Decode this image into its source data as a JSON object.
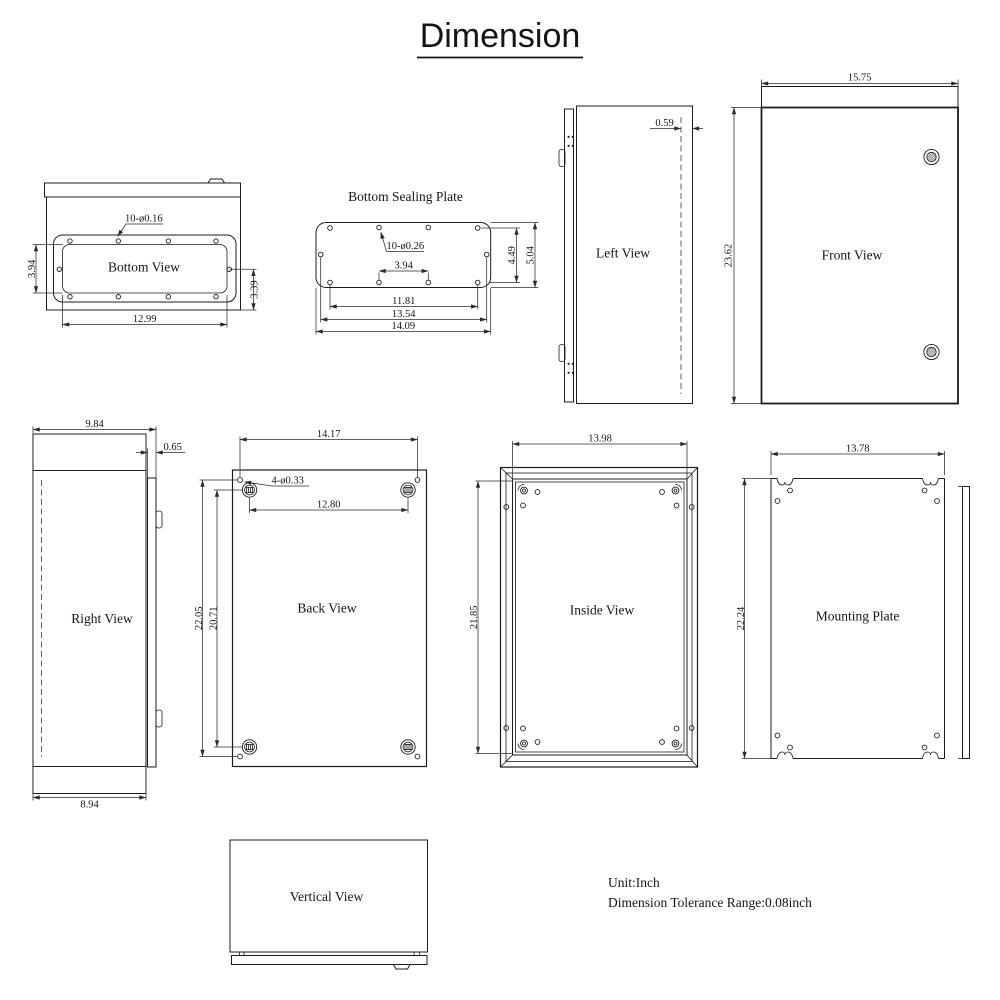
{
  "title": "Dimension",
  "notes": {
    "unit": "Unit:Inch",
    "tolerance": "Dimension Tolerance Range:0.08inch"
  },
  "views": {
    "bottom": {
      "label": "Bottom View",
      "dims": {
        "hole_note": "10-ø0.16",
        "groove_height": "3.94",
        "corner_offset": "3.39",
        "width": "12.99"
      }
    },
    "sealing": {
      "label": "Bottom Sealing Plate",
      "dims": {
        "hole_note": "10-ø0.26",
        "center_pitch": "3.94",
        "row_pitch": "4.49",
        "height": "5.04",
        "inner_width": "11.81",
        "mid_width": "13.54",
        "full_width": "14.09"
      }
    },
    "left": {
      "label": "Left View",
      "dims": {
        "door_depth": "0.59"
      }
    },
    "front": {
      "label": "Front View",
      "dims": {
        "width": "15.75",
        "height": "23.62"
      }
    },
    "right": {
      "label": "Right View",
      "dims": {
        "top_depth": "9.84",
        "door_depth": "0.65",
        "bottom_depth": "8.94"
      }
    },
    "back": {
      "label": "Back View",
      "dims": {
        "width": "14.17",
        "hole_note": "4-ø0.33",
        "boss_width": "12.80",
        "height": "22.05",
        "boss_height": "20.71"
      }
    },
    "inside": {
      "label": "Inside View",
      "dims": {
        "width": "13.98",
        "height": "21.85"
      }
    },
    "mounting": {
      "label": "Mounting Plate",
      "dims": {
        "width": "13.78",
        "height": "22.24"
      }
    },
    "vertical": {
      "label": "Vertical View"
    }
  },
  "colors": {
    "line": "#1c1c1c",
    "background": "#ffffff"
  }
}
